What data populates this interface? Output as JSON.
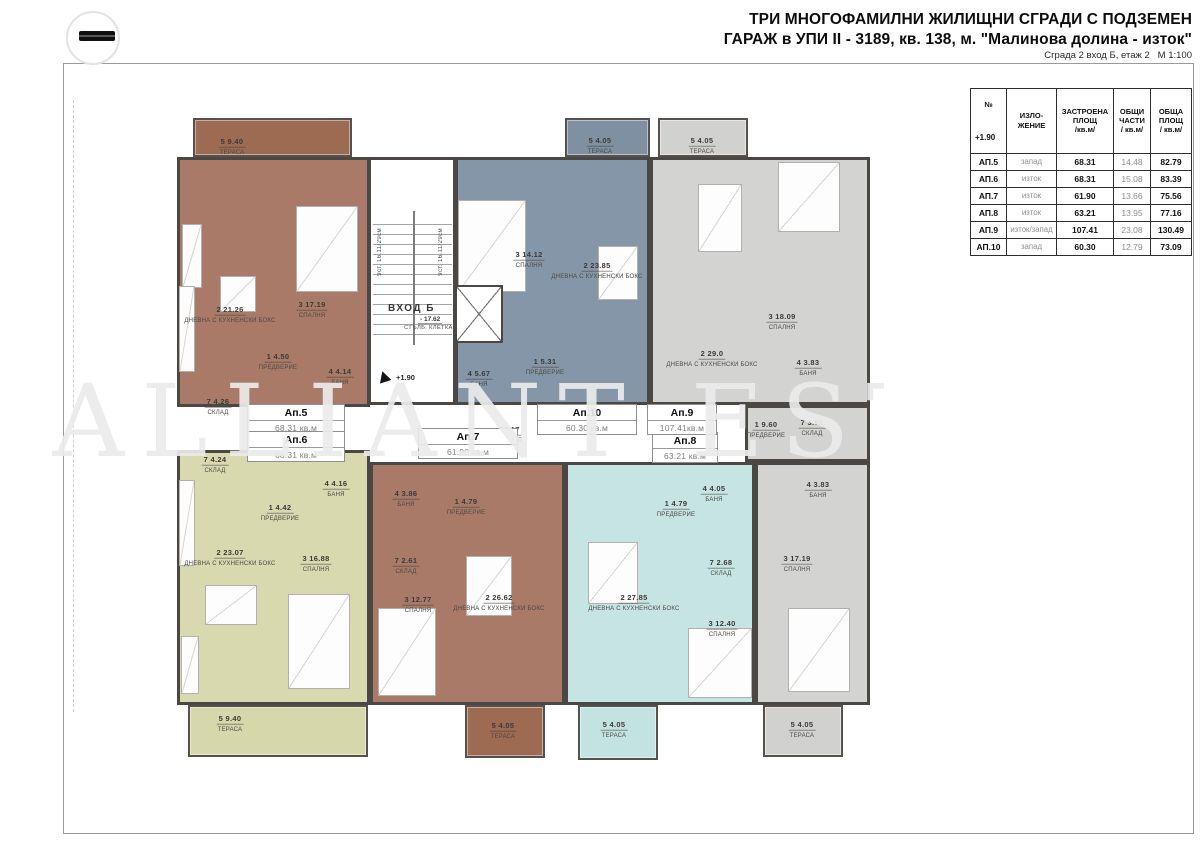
{
  "header": {
    "title_line1": "ТРИ МНОГОФАМИЛНИ ЖИЛИЩНИ СГРАДИ С ПОДЗЕМЕН",
    "title_line2": "ГАРАЖ в УПИ II - 3189, кв. 138, м. \"Малинова долина - изток\"",
    "subtitle": "Сграда 2 вход Б, етаж 2   М 1:100"
  },
  "watermark": {
    "text": "ALLIANT ESTATES"
  },
  "entrance": {
    "label": "ВХОД Б",
    "area_display": "- 17.62",
    "name": "СТЪЛБ. КЛЕТКА",
    "steps": "9ст. 16.11/29см",
    "level": "+1.90"
  },
  "corridor": {
    "area_display": "- 30.17",
    "name": "КОРИДОР"
  },
  "apartments": [
    {
      "id": "ap5",
      "name": "Ап.5",
      "area": "68.31 кв.м",
      "color": "#a87a67",
      "terrace_color": "#9d6a52",
      "box": [
        247,
        404,
        98
      ],
      "parts": [
        [
          177,
          157,
          193,
          250
        ]
      ],
      "terraces": [
        [
          193,
          118,
          159,
          39
        ]
      ],
      "rooms": [
        {
          "n": "5",
          "a": "9.40",
          "t": "ТЕРАСА",
          "x": 232,
          "y": 143
        },
        {
          "n": "2",
          "a": "21.26",
          "t": "ДНЕВНА С КУХНЕНСКИ БОКС",
          "x": 230,
          "y": 311
        },
        {
          "n": "3",
          "a": "17.19",
          "t": "СПАЛНЯ",
          "x": 312,
          "y": 306
        },
        {
          "n": "1",
          "a": "4.50",
          "t": "ПРЕДВЕРИЕ",
          "x": 278,
          "y": 358
        },
        {
          "n": "4",
          "a": "4.14",
          "t": "БАНЯ",
          "x": 340,
          "y": 373
        },
        {
          "n": "7",
          "a": "4.26",
          "t": "СКЛАД",
          "x": 218,
          "y": 403
        }
      ]
    },
    {
      "id": "ap6",
      "name": "Ап.6",
      "area": "68.31 кв.м",
      "color": "#d8d9ae",
      "terrace_color": "#d6d8ac",
      "box": [
        247,
        431,
        98
      ],
      "parts": [
        [
          177,
          450,
          193,
          255
        ]
      ],
      "terraces": [
        [
          188,
          705,
          180,
          52
        ]
      ],
      "rooms": [
        {
          "n": "7",
          "a": "4.24",
          "t": "СКЛАД",
          "x": 215,
          "y": 461
        },
        {
          "n": "4",
          "a": "4.16",
          "t": "БАНЯ",
          "x": 336,
          "y": 485
        },
        {
          "n": "1",
          "a": "4.42",
          "t": "ПРЕДВЕРИЕ",
          "x": 280,
          "y": 509
        },
        {
          "n": "2",
          "a": "23.07",
          "t": "ДНЕВНА С КУХНЕНСКИ БОКС",
          "x": 230,
          "y": 554
        },
        {
          "n": "3",
          "a": "16.88",
          "t": "СПАЛНЯ",
          "x": 316,
          "y": 560
        },
        {
          "n": "5",
          "a": "9.40",
          "t": "ТЕРАСА",
          "x": 230,
          "y": 720
        }
      ]
    },
    {
      "id": "ap7",
      "name": "Ап.7",
      "area": "61.90 кв.м",
      "color": "#a87a67",
      "terrace_color": "#9d6a52",
      "box": [
        418,
        428,
        100
      ],
      "parts": [
        [
          370,
          462,
          195,
          243
        ]
      ],
      "terraces": [
        [
          465,
          705,
          80,
          53
        ]
      ],
      "rooms": [
        {
          "n": "4",
          "a": "3.86",
          "t": "БАНЯ",
          "x": 406,
          "y": 495
        },
        {
          "n": "1",
          "a": "4.79",
          "t": "ПРЕДВЕРИЕ",
          "x": 466,
          "y": 503
        },
        {
          "n": "7",
          "a": "2.61",
          "t": "СКЛАД",
          "x": 406,
          "y": 562
        },
        {
          "n": "3",
          "a": "12.77",
          "t": "СПАЛНЯ",
          "x": 418,
          "y": 601
        },
        {
          "n": "2",
          "a": "26.62",
          "t": "ДНЕВНА С КУХНЕНСКИ БОКС",
          "x": 499,
          "y": 599
        },
        {
          "n": "5",
          "a": "4.05",
          "t": "ТЕРАСА",
          "x": 503,
          "y": 727
        }
      ]
    },
    {
      "id": "ap8",
      "name": "Ап.8",
      "area": "63.21 кв.м",
      "color": "#c6e5e2",
      "terrace_color": "#c3e3e0",
      "box": [
        652,
        432,
        66
      ],
      "parts": [
        [
          565,
          462,
          190,
          243
        ]
      ],
      "terraces": [
        [
          578,
          705,
          80,
          55
        ]
      ],
      "rooms": [
        {
          "n": "4",
          "a": "4.05",
          "t": "БАНЯ",
          "x": 714,
          "y": 490
        },
        {
          "n": "1",
          "a": "4.79",
          "t": "ПРЕДВЕРИЕ",
          "x": 676,
          "y": 505
        },
        {
          "n": "7",
          "a": "2.68",
          "t": "СКЛАД",
          "x": 721,
          "y": 564
        },
        {
          "n": "2",
          "a": "27.85",
          "t": "ДНЕВНА С КУХНЕНСКИ БОКС",
          "x": 634,
          "y": 599
        },
        {
          "n": "3",
          "a": "12.40",
          "t": "СПАЛНЯ",
          "x": 722,
          "y": 625
        },
        {
          "n": "5",
          "a": "4.05",
          "t": "ТЕРАСА",
          "x": 614,
          "y": 726
        }
      ]
    },
    {
      "id": "ap9",
      "name": "Ап.9",
      "area": "107.41кв.м",
      "color": "#d3d4d2",
      "terrace_color": "#d1d2d0",
      "box": [
        647,
        404,
        70
      ],
      "parts": [
        [
          650,
          157,
          220,
          248
        ],
        [
          745,
          405,
          125,
          57
        ],
        [
          755,
          462,
          115,
          243
        ]
      ],
      "terraces": [
        [
          658,
          118,
          90,
          39
        ],
        [
          763,
          705,
          80,
          52
        ]
      ],
      "rooms": [
        {
          "n": "5",
          "a": "4.05",
          "t": "ТЕРАСА",
          "x": 702,
          "y": 142
        },
        {
          "n": "3",
          "a": "18.09",
          "t": "СПАЛНЯ",
          "x": 782,
          "y": 318
        },
        {
          "n": "2",
          "a": "29.0",
          "t": "ДНЕВНА С КУХНЕНСКИ БОКС",
          "x": 712,
          "y": 355
        },
        {
          "n": "4",
          "a": "3.83",
          "t": "БАНЯ",
          "x": 808,
          "y": 364
        },
        {
          "n": "1",
          "a": "9.60",
          "t": "ПРЕДВЕРИЕ",
          "x": 766,
          "y": 426
        },
        {
          "n": "7",
          "a": "3.62",
          "t": "СКЛАД",
          "x": 812,
          "y": 424
        },
        {
          "n": "4",
          "a": "3.83",
          "t": "БАНЯ",
          "x": 818,
          "y": 486
        },
        {
          "n": "3",
          "a": "17.19",
          "t": "СПАЛНЯ",
          "x": 797,
          "y": 560
        },
        {
          "n": "5",
          "a": "4.05",
          "t": "ТЕРАСА",
          "x": 802,
          "y": 726
        }
      ]
    },
    {
      "id": "ap10",
      "name": "Ап.10",
      "area": "60.30 кв.м",
      "color": "#8496a8",
      "terrace_color": "#7e90a2",
      "box": [
        537,
        404,
        100
      ],
      "parts": [
        [
          455,
          157,
          195,
          248
        ]
      ],
      "terraces": [
        [
          565,
          118,
          85,
          39
        ]
      ],
      "rooms": [
        {
          "n": "5",
          "a": "4.05",
          "t": "ТЕРАСА",
          "x": 600,
          "y": 142
        },
        {
          "n": "3",
          "a": "14.12",
          "t": "СПАЛНЯ",
          "x": 529,
          "y": 256
        },
        {
          "n": "2",
          "a": "23.85",
          "t": "ДНЕВНА С КУХНЕНСКИ БОКС",
          "x": 597,
          "y": 267
        },
        {
          "n": "1",
          "a": "5.31",
          "t": "ПРЕДВЕРИЕ",
          "x": 545,
          "y": 363
        },
        {
          "n": "4",
          "a": "5.67",
          "t": "БАНЯ",
          "x": 479,
          "y": 375
        }
      ]
    }
  ],
  "table": {
    "headers": [
      "№",
      "ИЗЛО-\nЖЕНИЕ",
      "ЗАСТРОЕНА\nПЛОЩ\n/кв.м/",
      "ОБЩИ\nЧАСТИ\n/ кв.м/",
      "ОБЩА\nПЛОЩ\n/ кв.м/"
    ],
    "level": "+1.90",
    "rows": [
      {
        "no": "АП.5",
        "exposure": "запад",
        "built_up": "68.31",
        "common": "14.48",
        "total": "82.79"
      },
      {
        "no": "АП.6",
        "exposure": "изток",
        "built_up": "68.31",
        "common": "15.08",
        "total": "83.39"
      },
      {
        "no": "АП.7",
        "exposure": "изток",
        "built_up": "61.90",
        "common": "13.66",
        "total": "75.56"
      },
      {
        "no": "АП.8",
        "exposure": "изток",
        "built_up": "63.21",
        "common": "13.95",
        "total": "77.16"
      },
      {
        "no": "АП.9",
        "exposure": "изток/запад",
        "built_up": "107.41",
        "common": "23.08",
        "total": "130.49"
      },
      {
        "no": "АП.10",
        "exposure": "запад",
        "built_up": "60.30",
        "common": "12.79",
        "total": "73.09"
      }
    ]
  }
}
